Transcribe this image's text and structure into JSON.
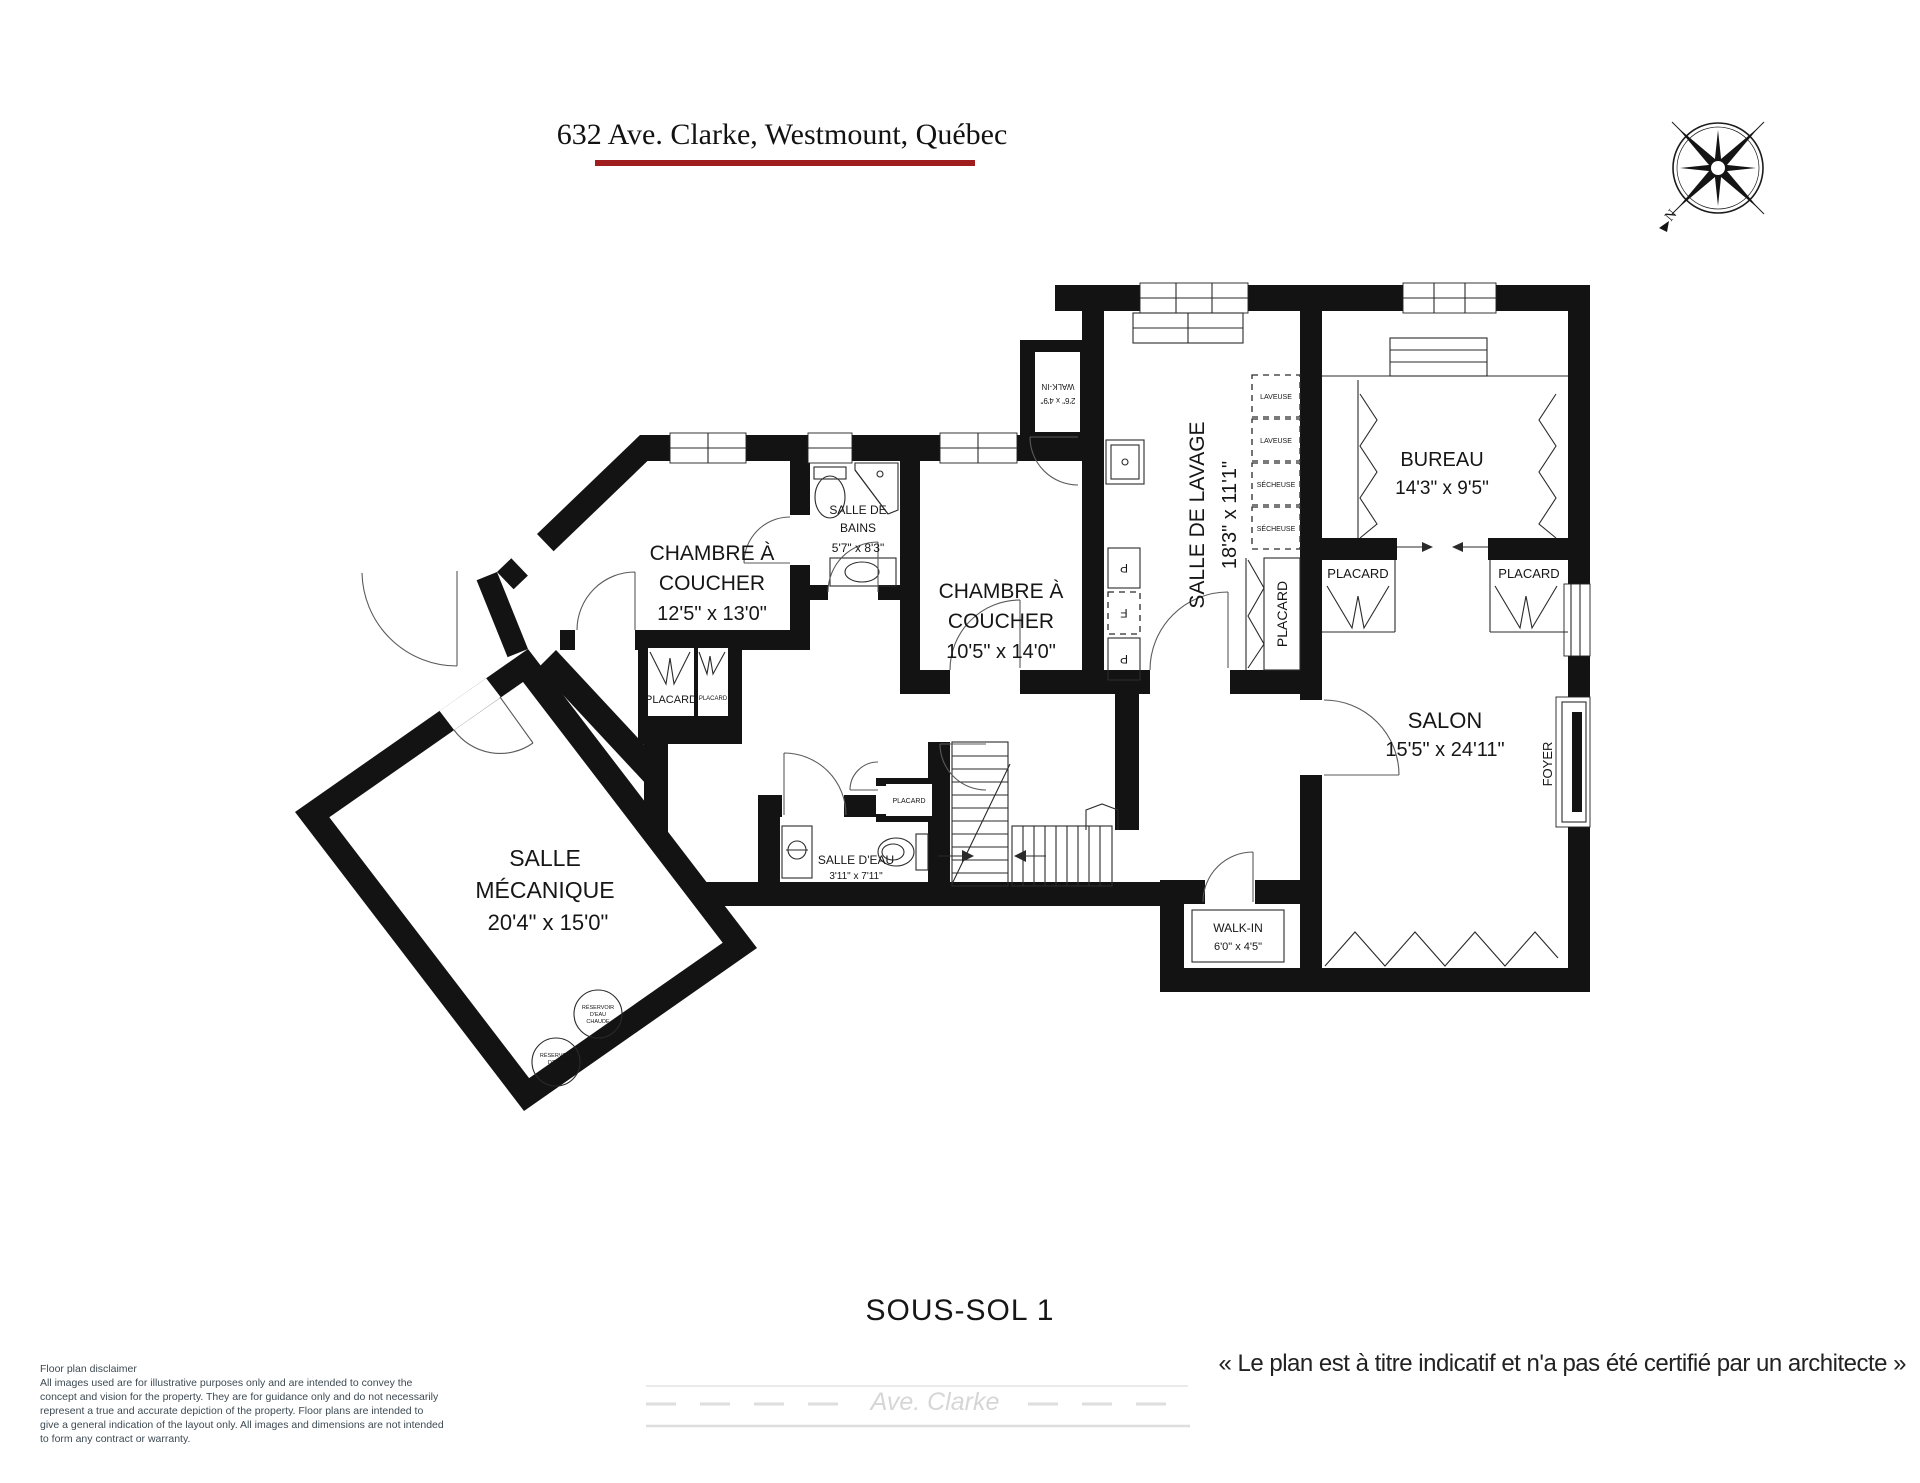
{
  "header": {
    "title": "632 Ave. Clarke, Westmount, Québec",
    "underline_color": "#a01d1d"
  },
  "compass": {
    "north": "N"
  },
  "rooms": {
    "chambre1": {
      "line1": "CHAMBRE À",
      "line2": "COUCHER",
      "dims": "12'5\" x 13'0\""
    },
    "bains": {
      "line1": "SALLE DE",
      "line2": "BAINS",
      "dims": "5'7\" x 8'3\""
    },
    "chambre2": {
      "line1": "CHAMBRE À",
      "line2": "COUCHER",
      "dims": "10'5\" x 14'0\""
    },
    "walkin_small": {
      "name": "WALK-IN",
      "dims": "2'6\" x 4'9\""
    },
    "lavage": {
      "name": "SALLE DE LAVAGE",
      "dims": "18'3\" x 11'1\""
    },
    "bureau": {
      "name": "BUREAU",
      "dims": "14'3\" x 9'5\""
    },
    "salon": {
      "name": "SALON",
      "dims": "15'5\" x 24'11\""
    },
    "mecanique": {
      "line1": "SALLE",
      "line2": "MÉCANIQUE",
      "dims": "20'4\" x 15'0\""
    },
    "salle_deau": {
      "name": "SALLE D'EAU",
      "dims": "3'11\" x 7'11\""
    },
    "walkin": {
      "name": "WALK-IN",
      "dims": "6'0\" x 4'5\""
    },
    "foyer": "FOYER",
    "placard": "PLACARD"
  },
  "appliances": {
    "laveuse": "LAVEUSE",
    "secheuse": "SÉCHEUSE",
    "p": "P",
    "f": "F",
    "res1": "RÉSERVOIR",
    "res2": "D'EAU",
    "res3": "CHAUDE"
  },
  "footer": {
    "floor": "SOUS-SOL 1",
    "note": "« Le plan est à titre indicatif et n'a pas été certifié par un architecte »",
    "street": "Ave. Clarke",
    "disclaimer_title": "Floor plan disclaimer",
    "disclaimer_body": "All images used are for illustrative purposes only and are intended to convey the concept and vision for the property. They are for guidance only and do not necessarily represent a true and accurate depiction of the property. Floor plans are intended to give a general indication of the layout only. All images and dimensions are not intended to form any contract or warranty."
  }
}
